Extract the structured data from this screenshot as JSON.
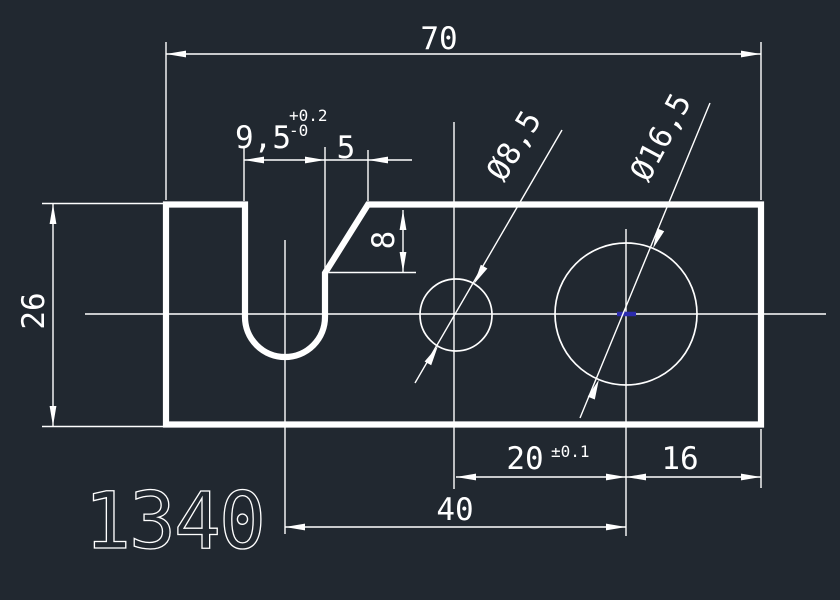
{
  "canvas": {
    "width": 840,
    "height": 600,
    "kind": "cad-model-space"
  },
  "colors": {
    "background": "#212830",
    "line": "#ffffff",
    "highlight": "#2b2bad"
  },
  "part_label": "1340",
  "dims": {
    "overall_width": "70",
    "overall_height": "26",
    "slot_width": "9,5",
    "slot_width_tol_plus": "+0.2",
    "slot_width_tol_minus": "-0",
    "chamfer_width": "5",
    "chamfer_depth": "8",
    "small_hole_dia": "Ø8,5",
    "large_hole_dia": "Ø16,5",
    "hole_spacing": "20",
    "hole_spacing_tol": "±0.1",
    "right_offset": "16",
    "slot_to_large_hole": "40"
  }
}
